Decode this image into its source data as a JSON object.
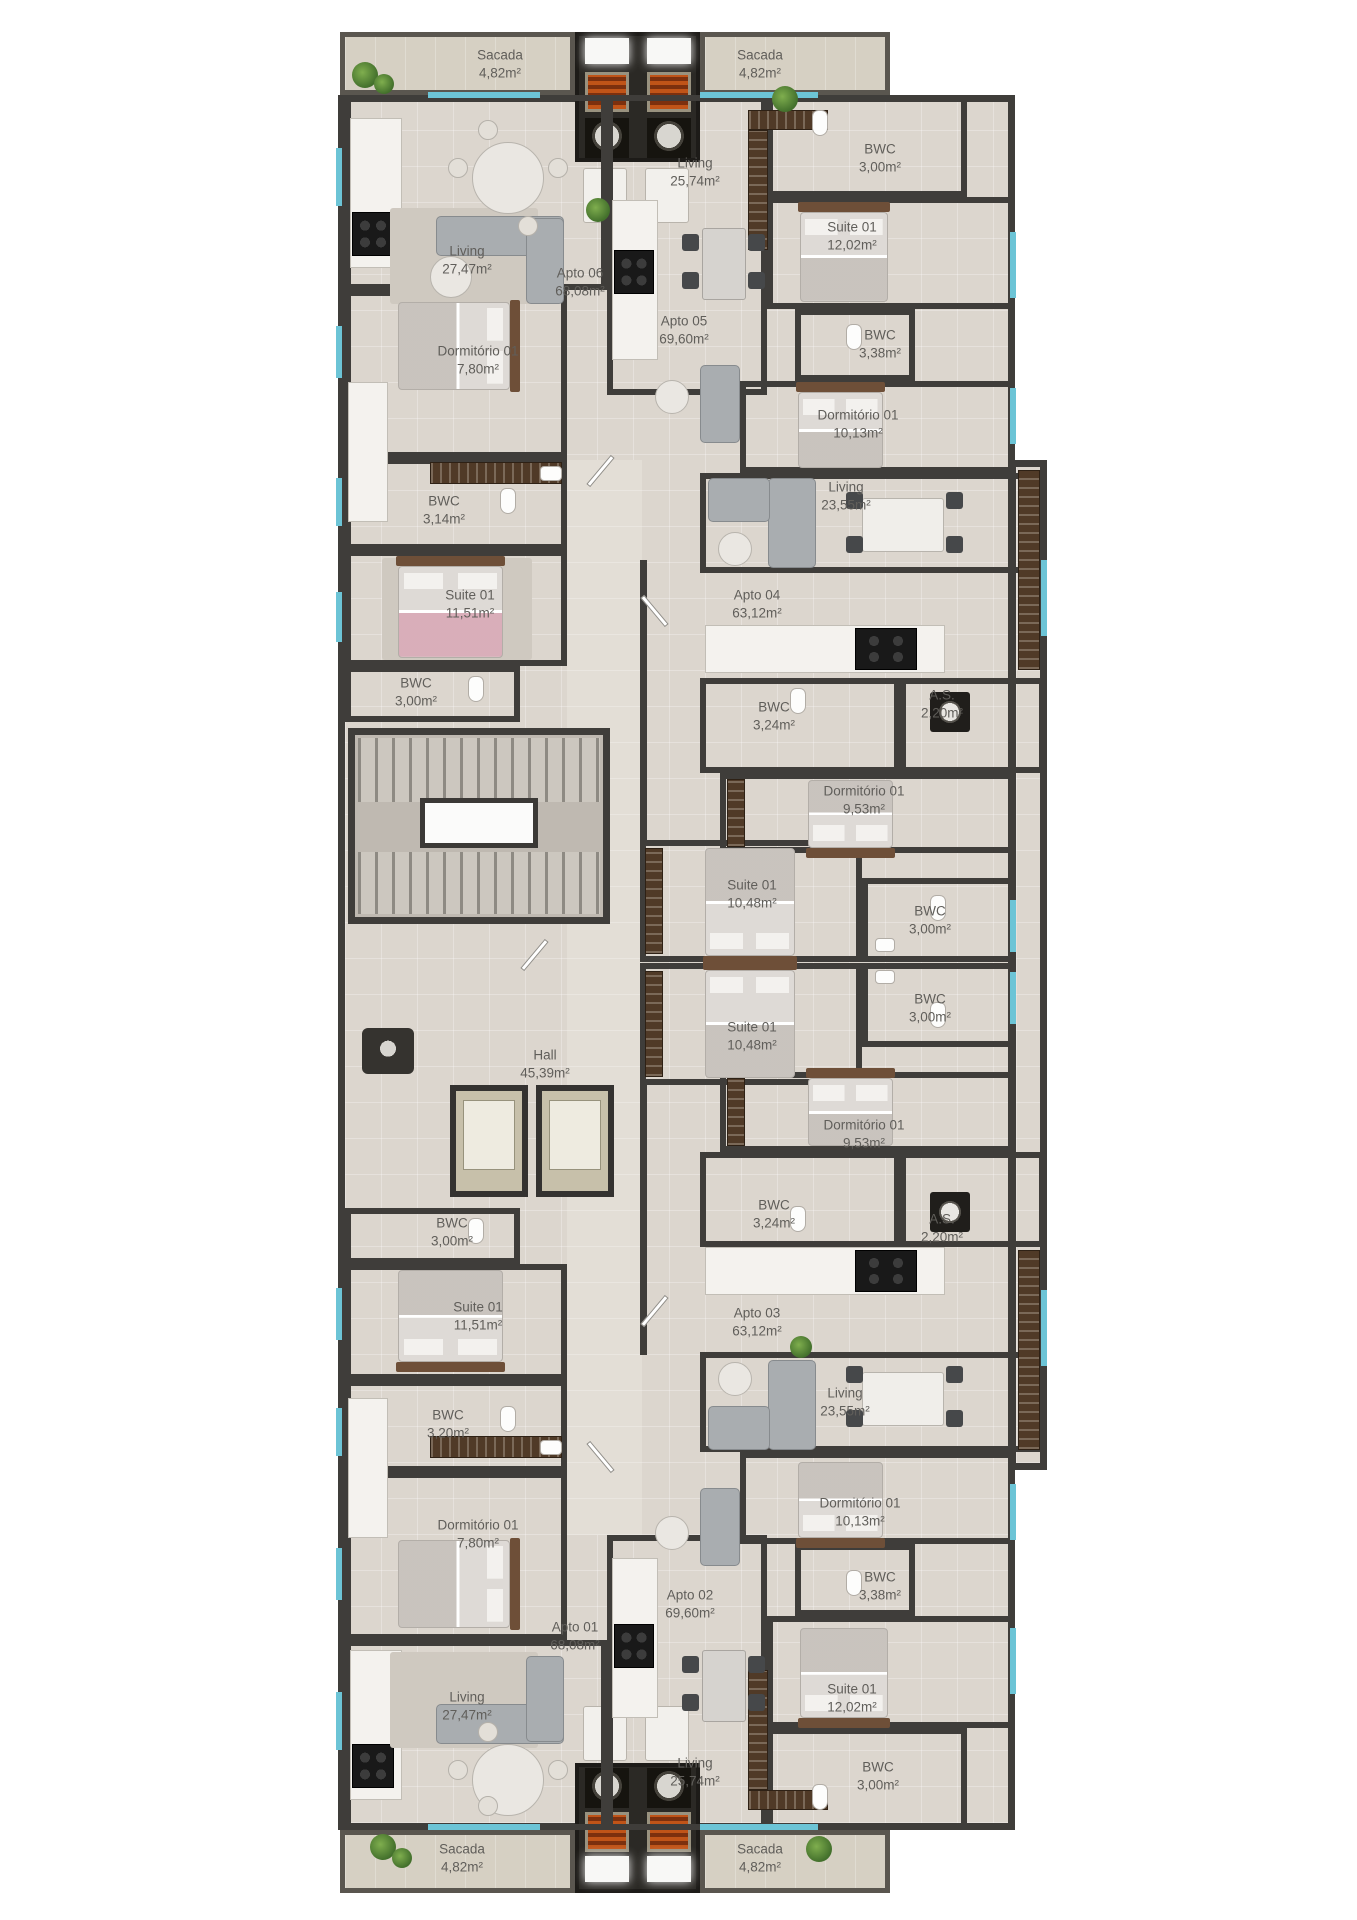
{
  "palette": {
    "wall": "#3f3d3a",
    "floor": "#dcd6ce",
    "corridor_floor": "#e3ded6",
    "balcony_floor": "#d6d0c3",
    "window_glass": "#6cc4d6",
    "wood_furniture": "#503a27",
    "grill_orange": "#c05418",
    "suite_pink_bed": "#d696aa",
    "label_text": "#605e5a"
  },
  "rooms": [
    {
      "id": "sacada-top-left",
      "name": "Sacada",
      "area": "4,82m²",
      "x": 500,
      "y": 64
    },
    {
      "id": "sacada-top-right",
      "name": "Sacada",
      "area": "4,82m²",
      "x": 760,
      "y": 64
    },
    {
      "id": "living-2574-top",
      "name": "Living",
      "area": "25,74m²",
      "x": 695,
      "y": 172
    },
    {
      "id": "bwc-300-apto05",
      "name": "BWC",
      "area": "3,00m²",
      "x": 880,
      "y": 158
    },
    {
      "id": "suite-1202-top",
      "name": "Suite 01",
      "area": "12,02m²",
      "x": 852,
      "y": 236
    },
    {
      "id": "living-2747-top",
      "name": "Living",
      "area": "27,47m²",
      "x": 467,
      "y": 260
    },
    {
      "id": "apto-06",
      "name": "Apto 06",
      "area": "68,08m²",
      "x": 580,
      "y": 282
    },
    {
      "id": "apto-05",
      "name": "Apto 05",
      "area": "69,60m²",
      "x": 684,
      "y": 330
    },
    {
      "id": "bwc-338-apto05",
      "name": "BWC",
      "area": "3,38m²",
      "x": 880,
      "y": 344
    },
    {
      "id": "dormitorio-780-top",
      "name": "Dormitório 01",
      "area": "7,80m²",
      "x": 478,
      "y": 360
    },
    {
      "id": "dormitorio-1013-top",
      "name": "Dormitório 01",
      "area": "10,13m²",
      "x": 858,
      "y": 424
    },
    {
      "id": "living-2355-top",
      "name": "Living",
      "area": "23,55m²",
      "x": 846,
      "y": 496
    },
    {
      "id": "bwc-314-apto06",
      "name": "BWC",
      "area": "3,14m²",
      "x": 444,
      "y": 510
    },
    {
      "id": "suite-1151-top",
      "name": "Suite 01",
      "area": "11,51m²",
      "x": 470,
      "y": 604
    },
    {
      "id": "apto-04",
      "name": "Apto 04",
      "area": "63,12m²",
      "x": 757,
      "y": 604
    },
    {
      "id": "bwc-300-apto06",
      "name": "BWC",
      "area": "3,00m²",
      "x": 416,
      "y": 692
    },
    {
      "id": "as-220-apto04",
      "name": "A.S.",
      "area": "2,20m²",
      "x": 942,
      "y": 704
    },
    {
      "id": "bwc-324-apto04",
      "name": "BWC",
      "area": "3,24m²",
      "x": 774,
      "y": 716
    },
    {
      "id": "dormitorio-953-apto04",
      "name": "Dormitório 01",
      "area": "9,53m²",
      "x": 864,
      "y": 800
    },
    {
      "id": "suite-1048-apto04",
      "name": "Suite 01",
      "area": "10,48m²",
      "x": 752,
      "y": 894
    },
    {
      "id": "bwc-300-apto04",
      "name": "BWC",
      "area": "3,00m²",
      "x": 930,
      "y": 920
    },
    {
      "id": "hall",
      "name": "Hall",
      "area": "45,39m²",
      "x": 545,
      "y": 1064
    },
    {
      "id": "bwc-300-apto03",
      "name": "BWC",
      "area": "3,00m²",
      "x": 930,
      "y": 1008
    },
    {
      "id": "suite-1048-apto03",
      "name": "Suite 01",
      "area": "10,48m²",
      "x": 752,
      "y": 1036
    },
    {
      "id": "dormitorio-953-apto03",
      "name": "Dormitório 01",
      "area": "9,53m²",
      "x": 864,
      "y": 1134
    },
    {
      "id": "bwc-324-apto03",
      "name": "BWC",
      "area": "3,24m²",
      "x": 774,
      "y": 1214
    },
    {
      "id": "as-220-apto03",
      "name": "A.S.",
      "area": "2,20m²",
      "x": 942,
      "y": 1228
    },
    {
      "id": "bwc-300-apto01",
      "name": "BWC",
      "area": "3,00m²",
      "x": 452,
      "y": 1232
    },
    {
      "id": "suite-1151-bottom",
      "name": "Suite 01",
      "area": "11,51m²",
      "x": 478,
      "y": 1316
    },
    {
      "id": "apto-03",
      "name": "Apto 03",
      "area": "63,12m²",
      "x": 757,
      "y": 1322
    },
    {
      "id": "living-2355-bottom",
      "name": "Living",
      "area": "23,55m²",
      "x": 845,
      "y": 1402
    },
    {
      "id": "bwc-320-apto01",
      "name": "BWC",
      "area": "3,20m²",
      "x": 448,
      "y": 1424
    },
    {
      "id": "dormitorio-780-bottom",
      "name": "Dormitório 01",
      "area": "7,80m²",
      "x": 478,
      "y": 1534
    },
    {
      "id": "dormitorio-1013-bottom",
      "name": "Dormitório 01",
      "area": "10,13m²",
      "x": 860,
      "y": 1512
    },
    {
      "id": "apto-02",
      "name": "Apto 02",
      "area": "69,60m²",
      "x": 690,
      "y": 1604
    },
    {
      "id": "apto-01",
      "name": "Apto 01",
      "area": "68,08m²",
      "x": 575,
      "y": 1636
    },
    {
      "id": "bwc-338-apto02",
      "name": "BWC",
      "area": "3,38m²",
      "x": 880,
      "y": 1586
    },
    {
      "id": "living-2747-bottom",
      "name": "Living",
      "area": "27,47m²",
      "x": 467,
      "y": 1706
    },
    {
      "id": "suite-1202-bottom",
      "name": "Suite 01",
      "area": "12,02m²",
      "x": 852,
      "y": 1698
    },
    {
      "id": "living-2574-bottom",
      "name": "Living",
      "area": "25,74m²",
      "x": 695,
      "y": 1772
    },
    {
      "id": "bwc-300-apto02",
      "name": "BWC",
      "area": "3,00m²",
      "x": 878,
      "y": 1776
    },
    {
      "id": "sacada-bottom-left",
      "name": "Sacada",
      "area": "4,82m²",
      "x": 462,
      "y": 1858
    },
    {
      "id": "sacada-bottom-right",
      "name": "Sacada",
      "area": "4,82m²",
      "x": 760,
      "y": 1858
    }
  ]
}
